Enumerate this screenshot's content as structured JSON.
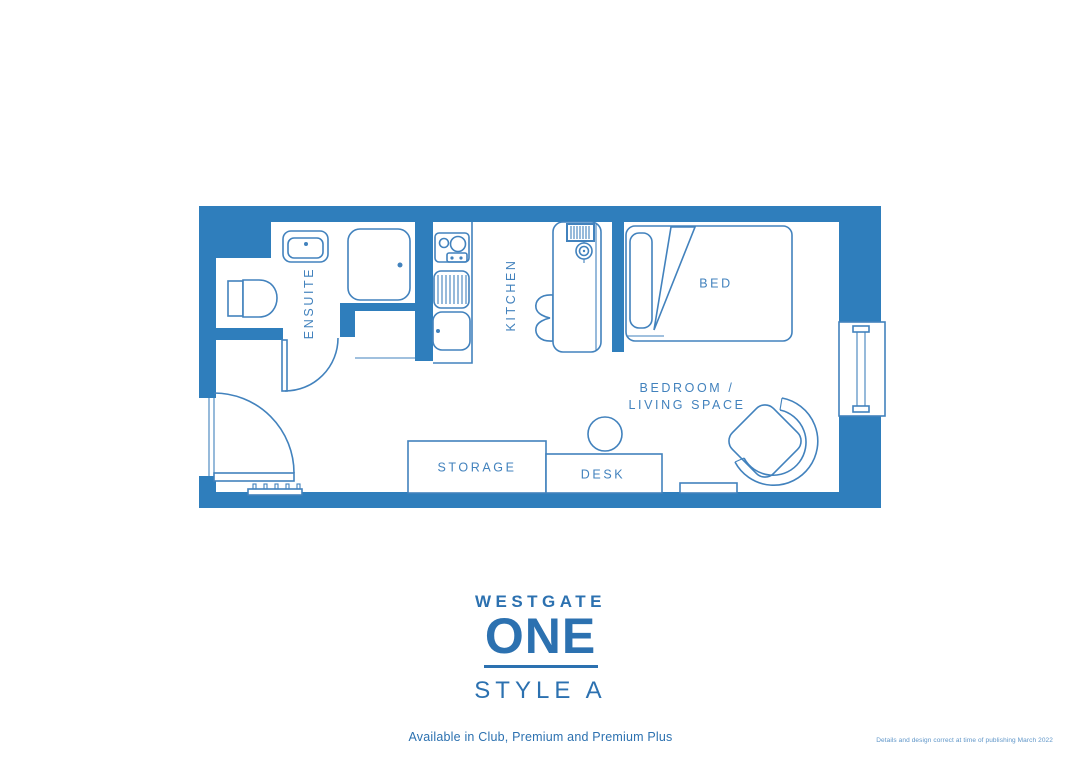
{
  "colors": {
    "wall": "#2f7ebc",
    "line": "#4282bd",
    "label": "#4282bd",
    "logo": "#2c71b0",
    "footnote": "#5e95c8"
  },
  "plan": {
    "labels": {
      "ensuite": "ENSUITE",
      "kitchen": "KITCHEN",
      "bed": "BED",
      "bedroom_line1": "BEDROOM /",
      "bedroom_line2": "LIVING SPACE",
      "storage": "STORAGE",
      "desk": "DESK"
    }
  },
  "branding": {
    "brand_top": "WESTGATE",
    "brand_main": "ONE",
    "style_name": "STYLE A",
    "availability": "Available in Club, Premium and Premium Plus"
  },
  "footnote": "Details and design correct at time of publishing March 2022"
}
